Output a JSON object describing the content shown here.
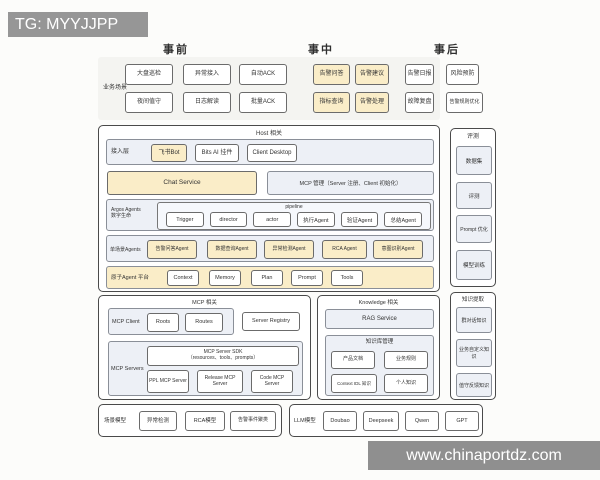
{
  "watermark": {
    "top_left": "TG: MYYJJPP",
    "bottom_right": "www.chinaportdz.com"
  },
  "phases": {
    "pre": "事前",
    "mid": "事中",
    "post": "事后"
  },
  "business": {
    "label": "业务场景",
    "row1": [
      {
        "label": "大盘巡检",
        "hl": false
      },
      {
        "label": "异常接入",
        "hl": false
      },
      {
        "label": "自动ACK",
        "hl": false
      },
      {
        "label": "告警问答",
        "hl": true
      },
      {
        "label": "告警建议",
        "hl": true
      },
      {
        "label": "告警日报",
        "hl": false
      },
      {
        "label": "风险预防",
        "hl": false
      }
    ],
    "row2": [
      {
        "label": "夜间值守",
        "hl": false
      },
      {
        "label": "日志解读",
        "hl": false
      },
      {
        "label": "批量ACK",
        "hl": false
      },
      {
        "label": "指标查询",
        "hl": true
      },
      {
        "label": "告警处理",
        "hl": true
      },
      {
        "label": "故障复盘",
        "hl": false
      },
      {
        "label": "告警规则优化",
        "hl": false
      }
    ]
  },
  "host": {
    "title": "Host 相关",
    "access": {
      "label": "接入层",
      "items": [
        "飞书Bot",
        "Bits AI 挂件",
        "Client Desktop"
      ]
    },
    "chat_service": "Chat Service",
    "mcp_manage": "MCP 管理（Server 注册、Client 初始化）",
    "pipeline": {
      "title": "pipeline",
      "owner_line1": "Argos Agents",
      "owner_line2": "数字生命",
      "items": [
        "Trigger",
        "director",
        "actor",
        "执行Agent",
        "验证Agent",
        "总结Agent"
      ]
    },
    "scene_agents": {
      "label": "单场景Agents",
      "items": [
        "告警问答Agent",
        "数据查询Agent",
        "异常检测Agent",
        "RCA Agent",
        "意图识别Agent"
      ]
    },
    "atomic_platform": {
      "label": "原子Agent 平台",
      "items": [
        "Context",
        "Memory",
        "Plan",
        "Prompt",
        "Tools"
      ]
    }
  },
  "mcp": {
    "title": "MCP 相关",
    "client": {
      "label": "MCP Client",
      "items": [
        "Roots",
        "Routes"
      ]
    },
    "server_registry": "Server Registry",
    "servers": {
      "label": "MCP Servers",
      "sdk_line1": "MCP Server SDK",
      "sdk_line2": "（resources、tools、prompts）",
      "items": [
        "PPL MCP Server",
        "Release MCP Server",
        "Code MCP Server"
      ]
    }
  },
  "knowledge": {
    "title": "Knowledge 相关",
    "rag": "RAG Service",
    "kb": {
      "label": "知识库管理",
      "items": [
        "产品文档",
        "业务规则",
        "Context IDL 知识",
        "个人知识"
      ]
    }
  },
  "evaluation": {
    "title": "评测",
    "items": [
      "数据集",
      "评测",
      "Prompt 优化",
      "模型训练"
    ]
  },
  "extraction": {
    "title": "知识提取",
    "items": [
      "群对话知识",
      "业务自定义知识",
      "值守反馈知识"
    ]
  },
  "scene_models": {
    "label": "场景模型",
    "items": [
      "异常检测",
      "RCA模型",
      "告警事件聚类"
    ]
  },
  "llm_models": {
    "label": "LLM模型",
    "items": [
      "Doubao",
      "Deepseek",
      "Qwen",
      "GPT"
    ]
  },
  "colors": {
    "highlight": "#FAEDC8",
    "panel": "#EDF0F6",
    "panelBorder": "#8A8F98",
    "boxBorder": "#6B6B6B",
    "sectionBorder": "#4A4A4A",
    "watermarkBg": "#969696",
    "text": "#333333",
    "pageBg": "#FCFCFA",
    "businessBg": "#F4F4F1"
  }
}
